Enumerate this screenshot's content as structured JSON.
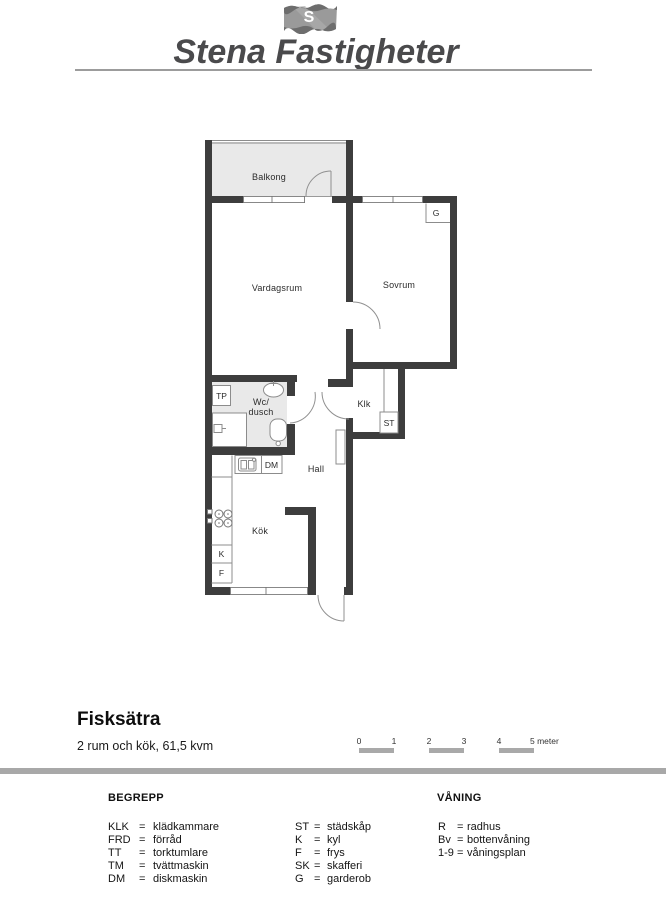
{
  "logo": {
    "flag_letter": "S",
    "brand": "Stena Fastigheter"
  },
  "plan": {
    "labels": {
      "balkong": "Balkong",
      "vardagsrum": "Vardagsrum",
      "sovrum": "Sovrum",
      "wc_line1": "Wc/",
      "wc_line2": "dusch",
      "klk": "Klk",
      "hall": "Hall",
      "kok": "Kök",
      "tp": "TP",
      "dm": "DM",
      "k": "K",
      "f": "F",
      "g": "G",
      "st": "ST"
    }
  },
  "info": {
    "title": "Fisksätra",
    "subtitle": "2 rum och kök, 61,5 kvm"
  },
  "scale": {
    "labels": [
      "0",
      "1",
      "2",
      "3",
      "4",
      "5 meter"
    ]
  },
  "legend": {
    "heading_terms": "BEGREPP",
    "heading_floor": "VÅNING",
    "terms_col1": [
      {
        "abbr": "KLK",
        "eq": "=",
        "def": "klädkammare"
      },
      {
        "abbr": "FRD",
        "eq": "=",
        "def": "förråd"
      },
      {
        "abbr": "TT",
        "eq": "=",
        "def": "torktumlare"
      },
      {
        "abbr": "TM",
        "eq": "=",
        "def": "tvättmaskin"
      },
      {
        "abbr": "DM",
        "eq": "=",
        "def": "diskmaskin"
      }
    ],
    "terms_col2": [
      {
        "abbr": "ST",
        "eq": "=",
        "def": "städskåp"
      },
      {
        "abbr": "K",
        "eq": "=",
        "def": "kyl"
      },
      {
        "abbr": "F",
        "eq": "=",
        "def": "frys"
      },
      {
        "abbr": "SK",
        "eq": "=",
        "def": "skafferi"
      },
      {
        "abbr": "G",
        "eq": "=",
        "def": "garderob"
      }
    ],
    "floor": [
      {
        "abbr": "R",
        "eq": "=",
        "def": "radhus"
      },
      {
        "abbr": "Bv",
        "eq": "=",
        "def": "bottenvåning"
      },
      {
        "abbr": "1-9",
        "eq": "=",
        "def": "våningsplan"
      }
    ]
  },
  "colors": {
    "wall": "#3d3d3d",
    "floor_shade": "#e9e9e9",
    "thin_line": "#8c8c8c",
    "logo_text": "#4a4a4c",
    "divider": "#a8a8a8",
    "scale_bar": "#a9a9a9"
  }
}
